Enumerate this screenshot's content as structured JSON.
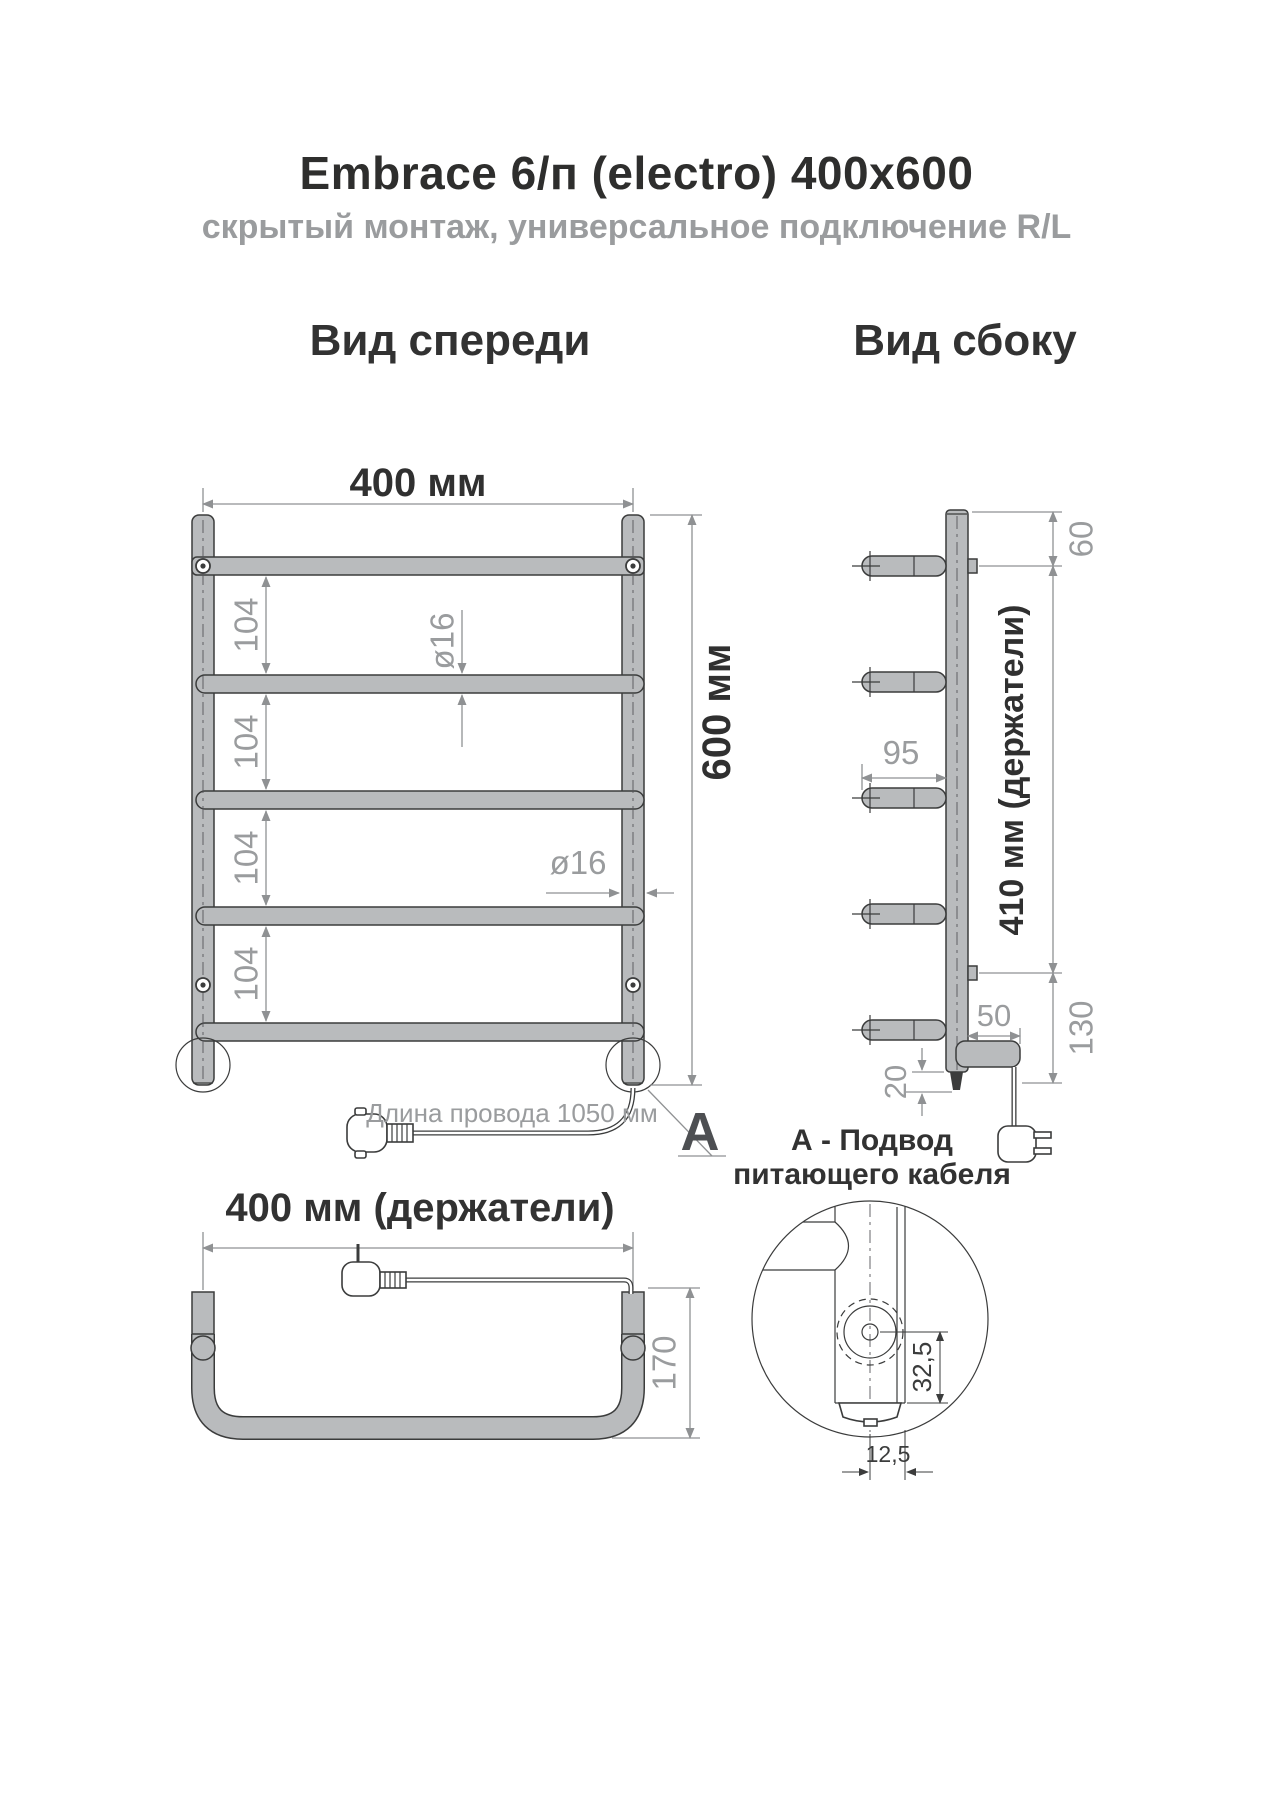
{
  "title": "Embrace 6/п (electro) 400x600",
  "subtitle": "скрытый монтаж, универсальное подключение R/L",
  "colors": {
    "tube_fill": "#b9bbbd",
    "outline": "#3b3c3c",
    "dimension_gray": "#9a9c9e",
    "heading_dark": "#323232",
    "marker_gray": "#4d4f52"
  },
  "front_view": {
    "heading": "Вид спереди",
    "width_dim": "400 мм",
    "height_dim": "600 мм",
    "bar_spacing_dims": [
      "104",
      "104",
      "104",
      "104"
    ],
    "bar_diameter_dim": "ø16",
    "post_diameter_dim": "ø16",
    "cable_length_note": "Длина провода 1050 мм",
    "detail_marker": "А"
  },
  "side_view": {
    "heading": "Вид сбоку",
    "top_offset_dim": "60",
    "holder_depth_dim": "95",
    "holders_span_dim": "410 мм (держатели)",
    "unit_length_dim": "50",
    "unit_offset_dim": "130",
    "foot_dim": "20"
  },
  "bottom_view": {
    "heading": "400 мм (держатели)",
    "depth_dim": "170"
  },
  "detail_view": {
    "caption_line1": "А - Подвод",
    "caption_line2": "питающего кабеля",
    "axis_offset_dim": "32,5",
    "cap_offset_dim": "12,5"
  }
}
